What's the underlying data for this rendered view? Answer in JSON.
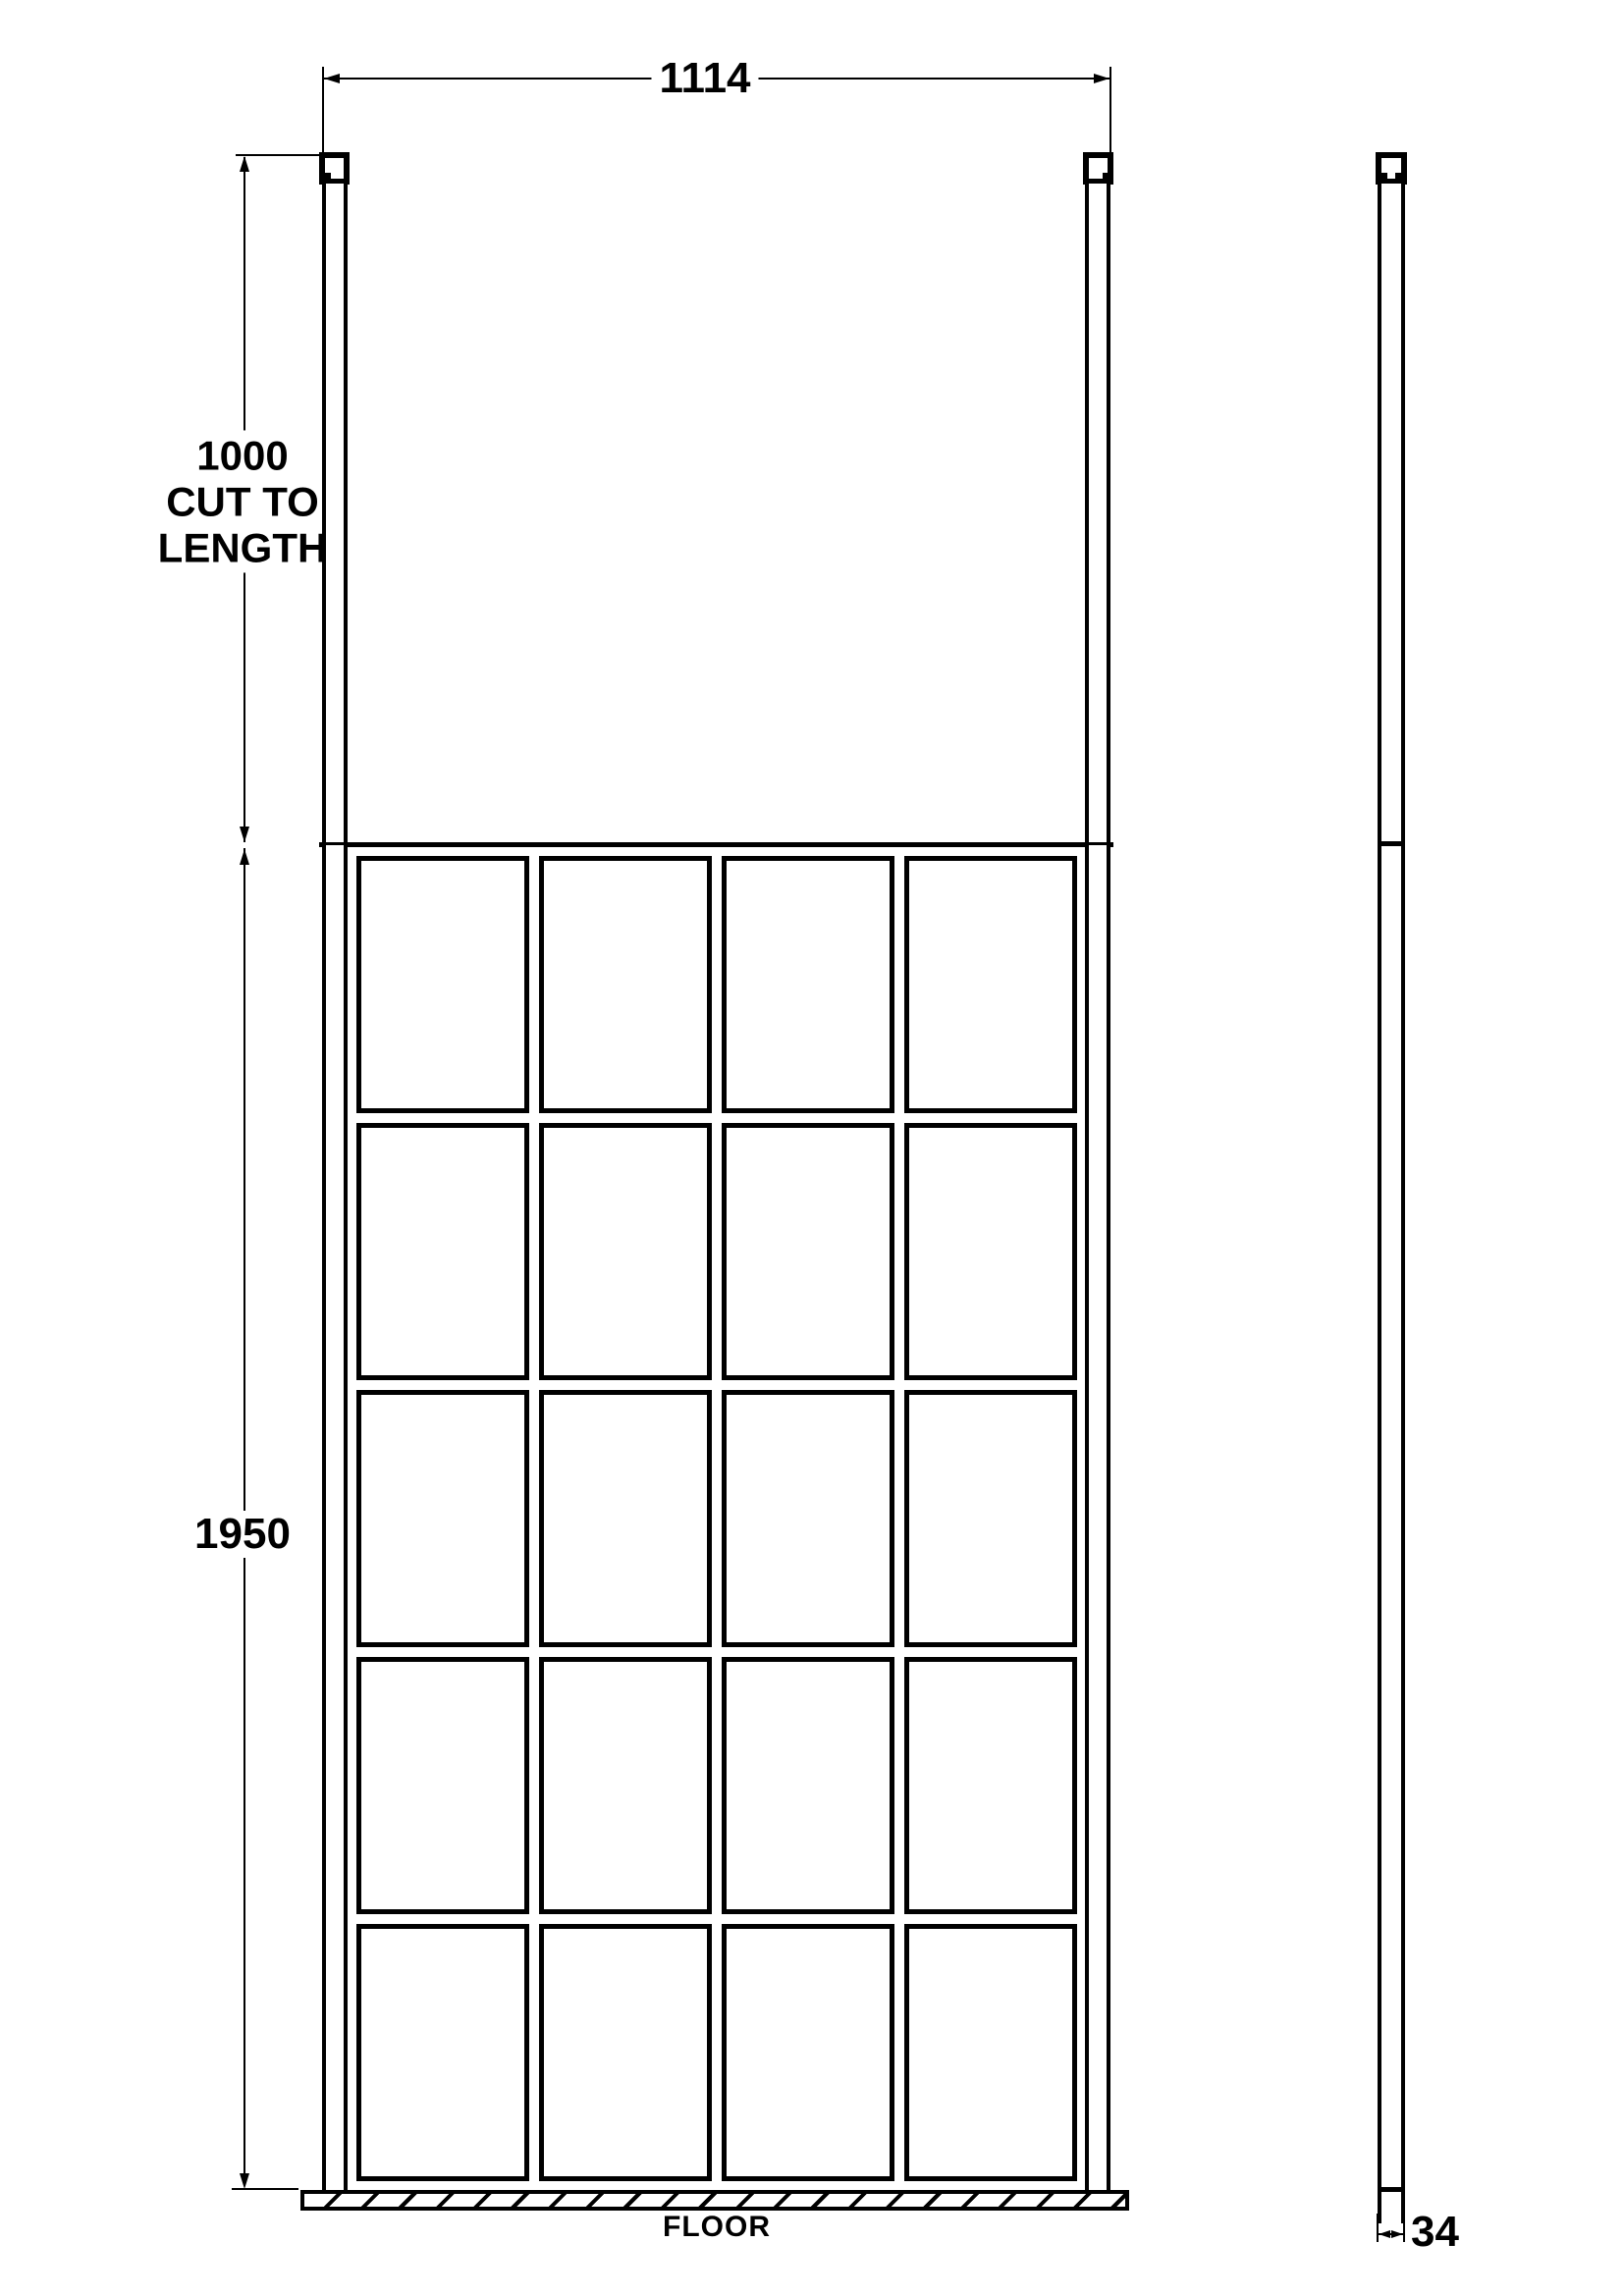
{
  "drawing": {
    "type": "technical-drawing",
    "colors": {
      "line": "#000000",
      "background": "#ffffff"
    },
    "grid": {
      "columns": 4,
      "rows": 5
    },
    "dimensions": {
      "width": "1114",
      "post_line1": "1000",
      "post_line2": "CUT TO",
      "post_line3": "LENGTH",
      "height": "1950",
      "depth": "34"
    },
    "labels": {
      "floor": "FLOOR"
    }
  }
}
